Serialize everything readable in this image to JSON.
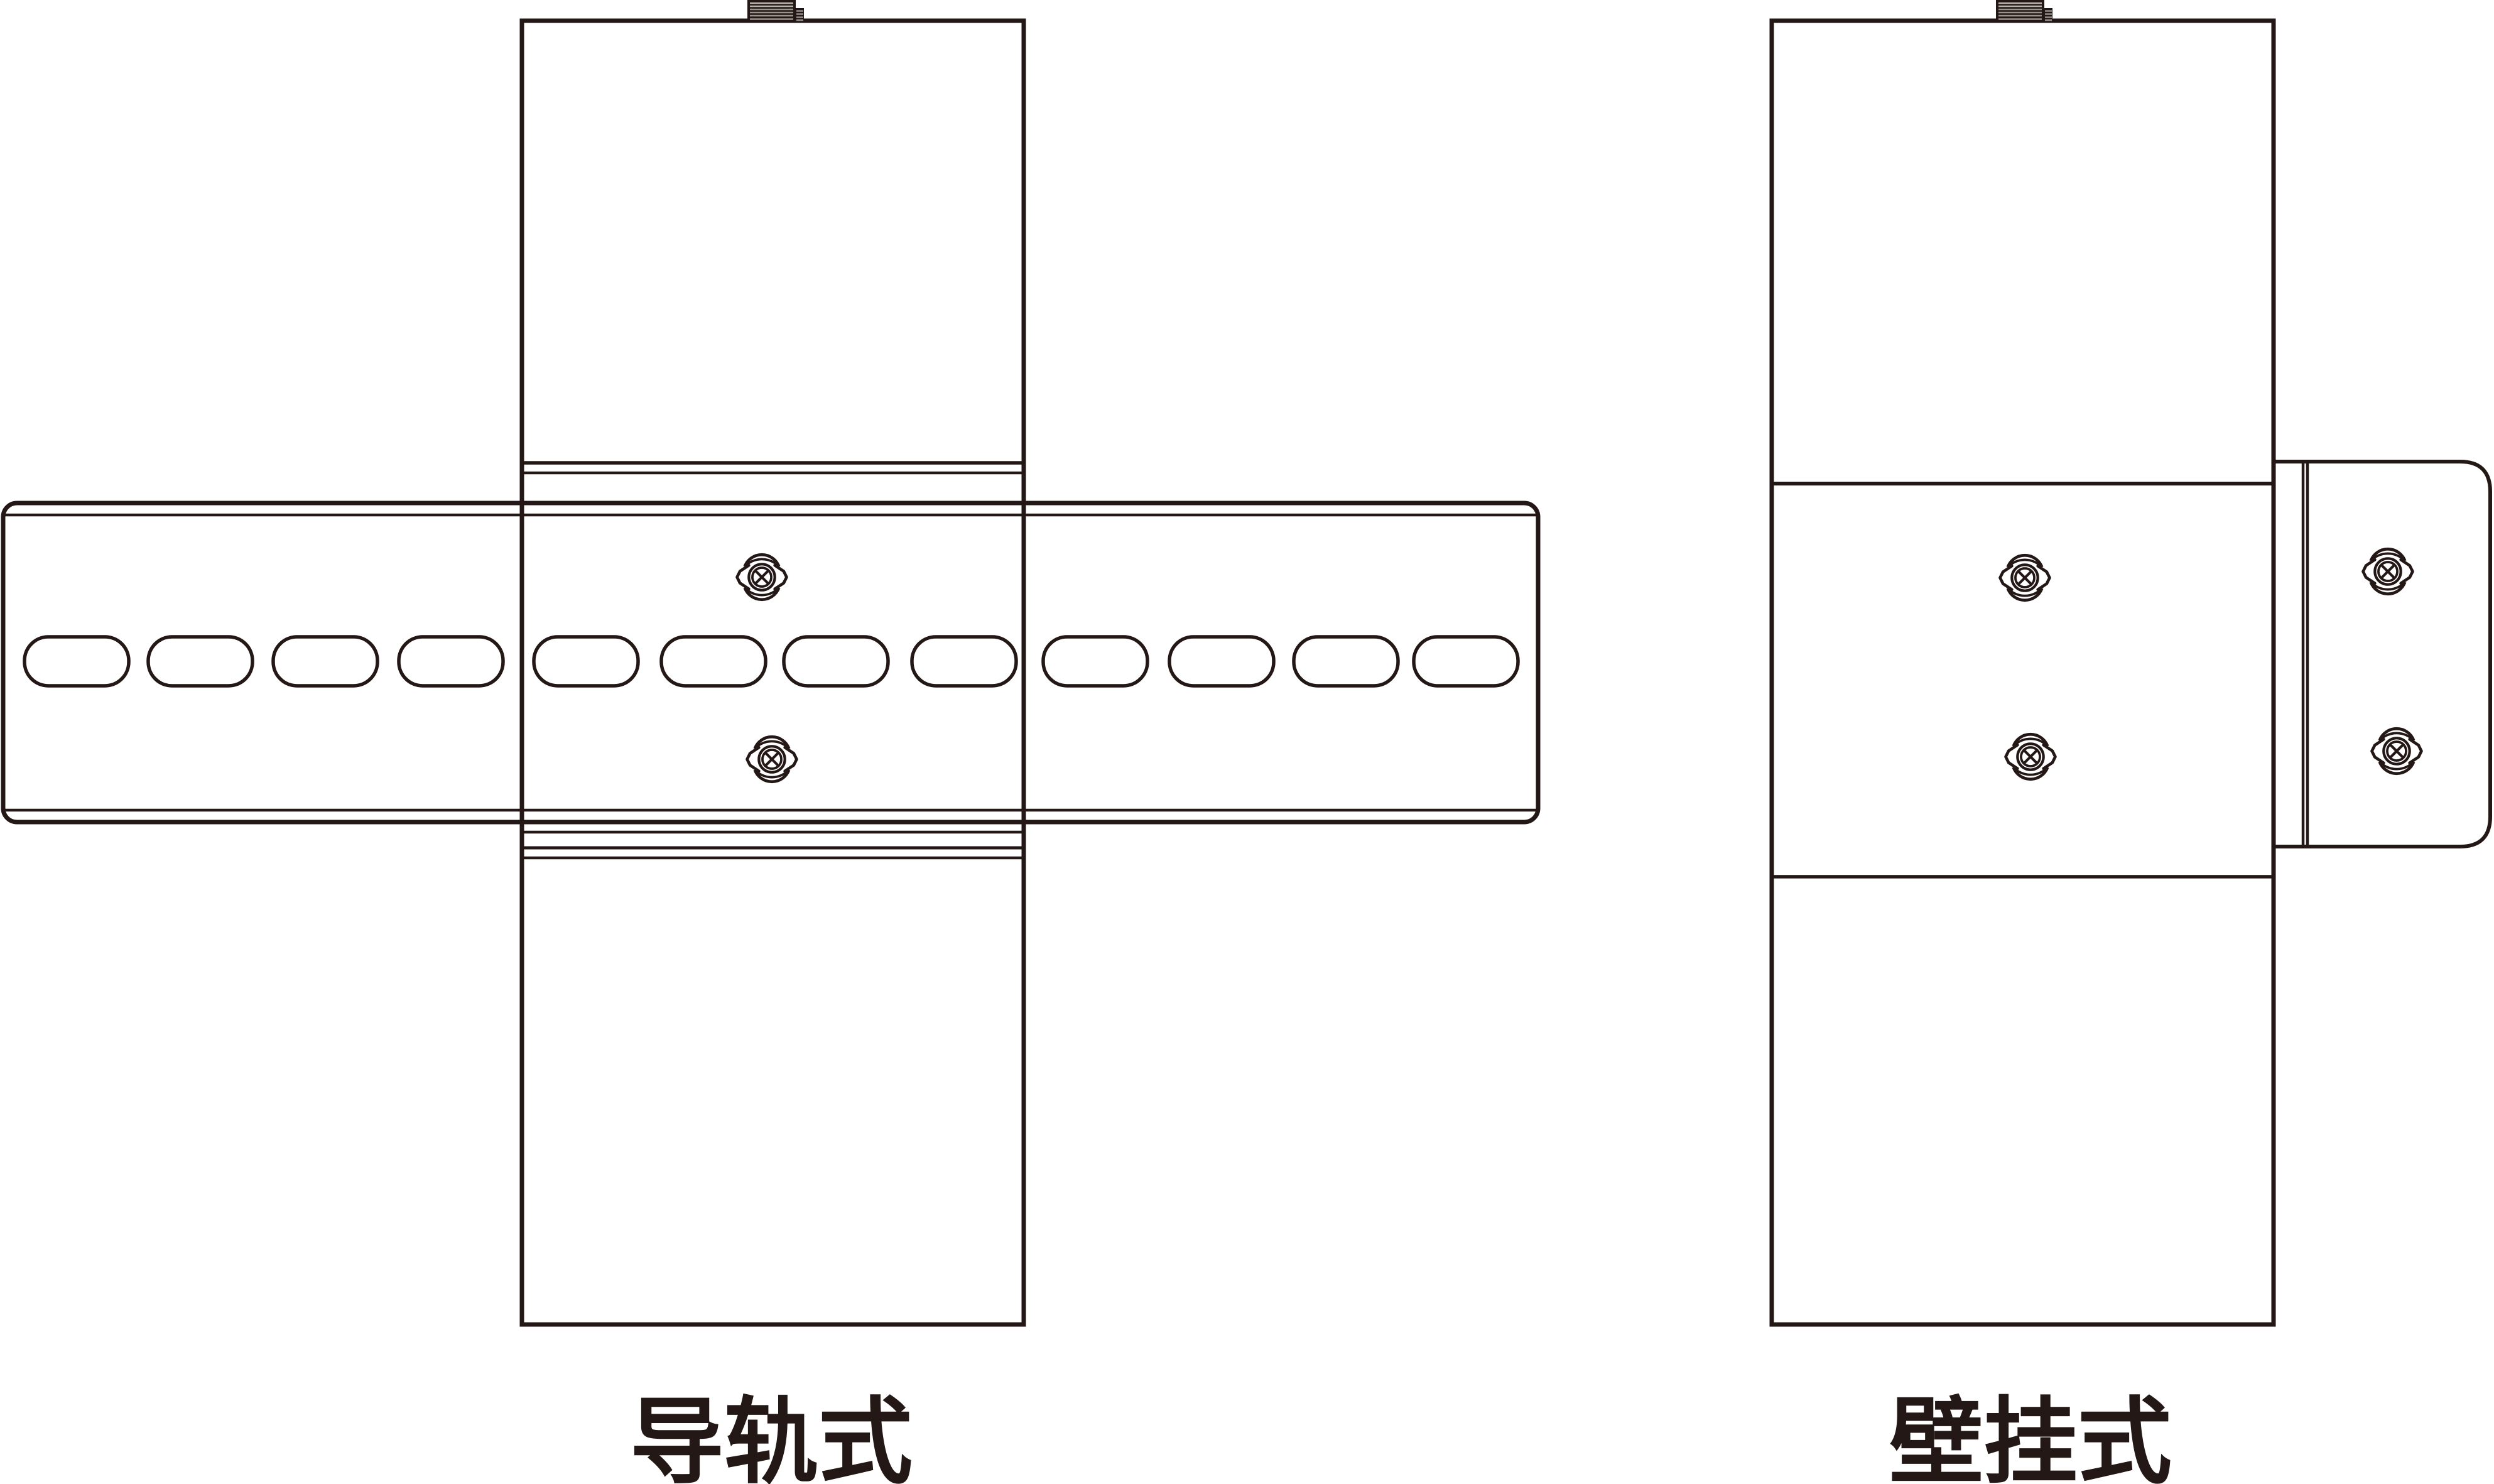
{
  "colors": {
    "background": "#ffffff",
    "line": "#231815",
    "connector_fill": "#231815",
    "thread_stripe": "#9a948f",
    "thread_stripe_highlight": "#b8b2ad"
  },
  "captions": {
    "left": "导轨式",
    "right": "壁挂式"
  },
  "left_diagram": {
    "name": "din-rail-mounting",
    "caption": "导轨式",
    "rail_slot_count": 12,
    "screw_count": 2,
    "icons": [
      "antenna-connector-icon",
      "phillips-screw-icon",
      "din-rail",
      "rail-slot"
    ]
  },
  "right_diagram": {
    "name": "wall-mounting",
    "caption": "壁挂式",
    "device_screw_count": 2,
    "bracket_screw_count": 2,
    "icons": [
      "antenna-connector-icon",
      "phillips-screw-icon",
      "wall-bracket"
    ]
  }
}
